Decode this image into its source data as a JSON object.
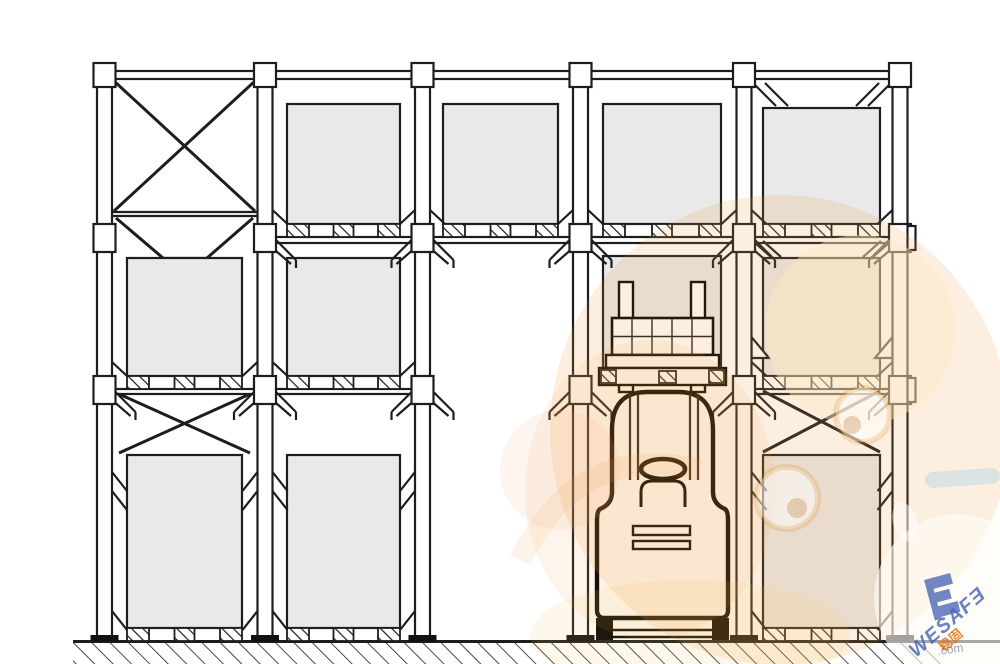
{
  "diagram": {
    "type": "technical-drawing",
    "subject": "Drive-in pallet racking front elevation with a reach truck placing a pallet",
    "columns": 6,
    "bays": 5,
    "load_levels": 3,
    "bay_contents": [
      {
        "bay": 1,
        "top": "cross-brace",
        "middle": "pallet load",
        "bottom": "cross-brace + pallet load"
      },
      {
        "bay": 2,
        "top": "pallet load",
        "middle": "pallet load",
        "bottom": "pallet load"
      },
      {
        "bay": 3,
        "top": "pallet load",
        "middle": "empty aisle",
        "bottom": "empty aisle"
      },
      {
        "bay": 4,
        "top": "pallet load",
        "middle": "stored load + lifted pallet",
        "bottom": "reach truck"
      },
      {
        "bay": 5,
        "top": "pallet load",
        "middle": "pallet load",
        "bottom": "cross-brace + pallet load"
      }
    ]
  },
  "watermark": {
    "brand": "WESAFƎ",
    "logo_letter": "E",
    "caption": "稳固",
    "url_fragment": ".com"
  },
  "colors": {
    "line": "#1d1d1d",
    "load_fill": "#e9e9e9",
    "wm_orange": "#f09a3f",
    "wm_cream": "#fbe8c3",
    "wm_blue": "#4a66b8",
    "wm_orange_text": "#e07818"
  }
}
